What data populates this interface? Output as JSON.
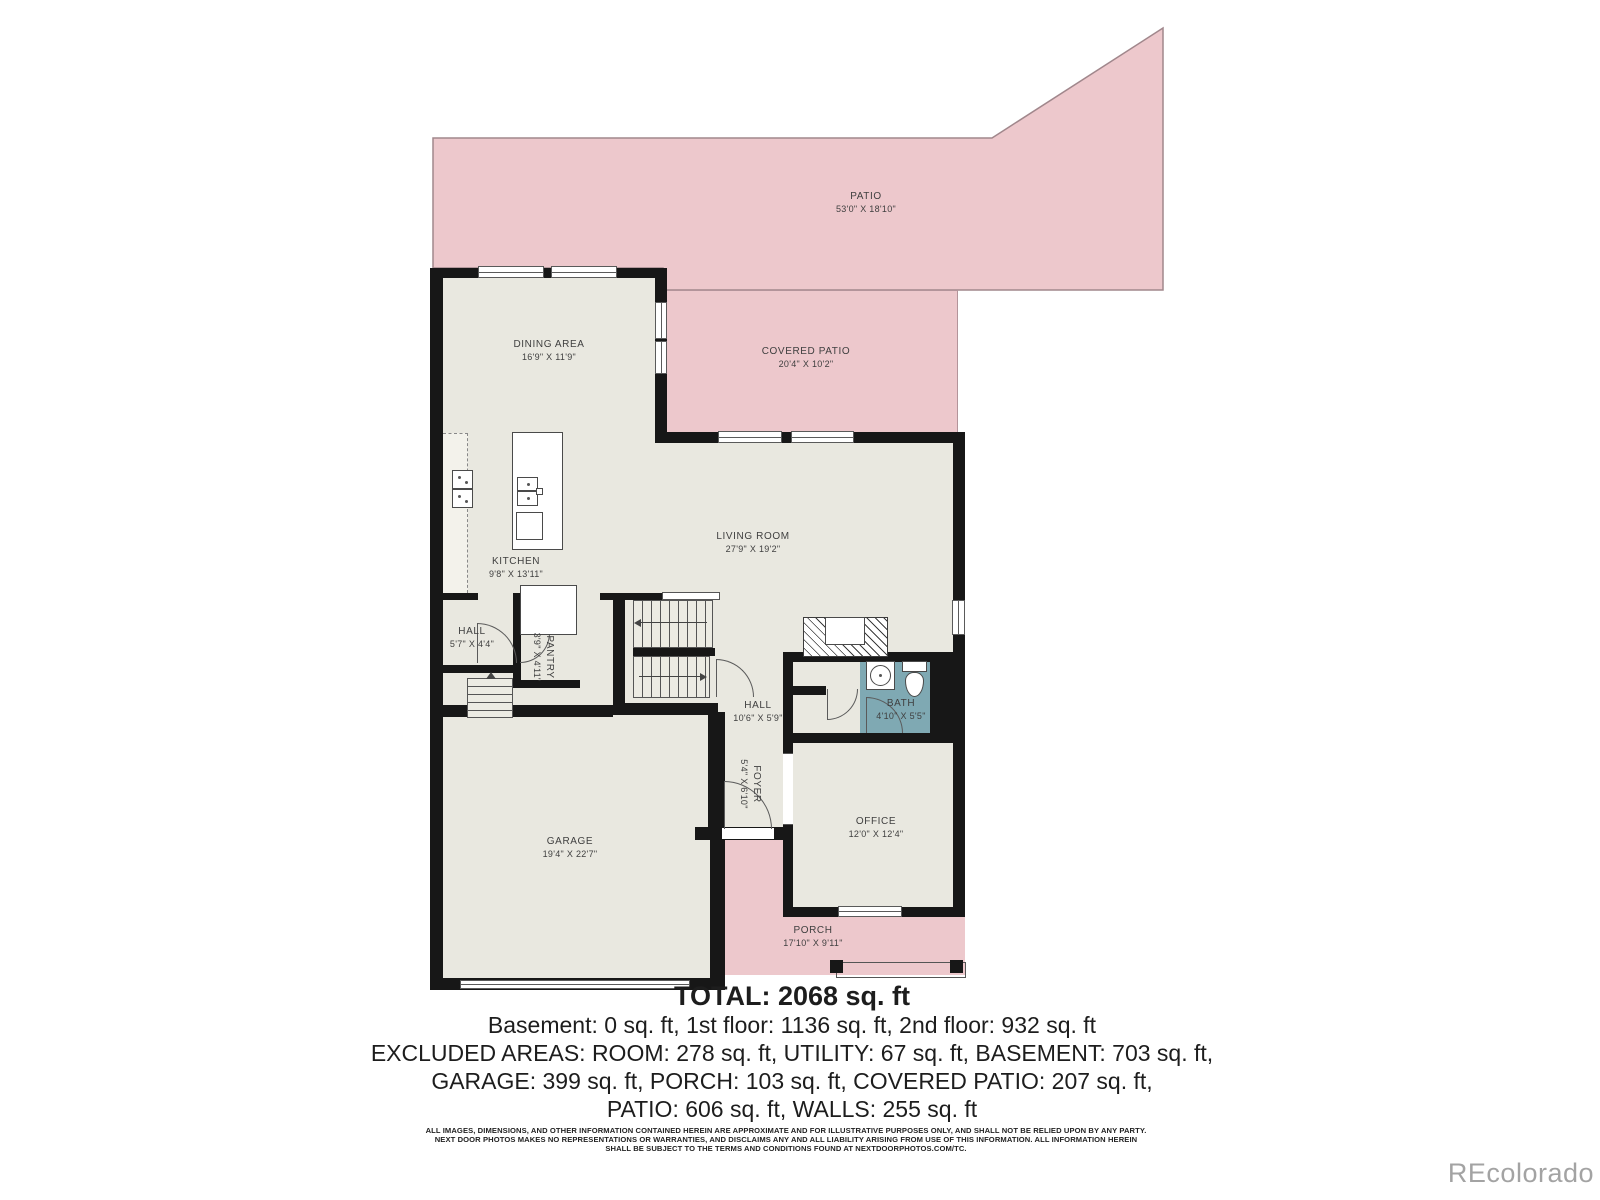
{
  "colors": {
    "room_fill": "#e9e8e0",
    "outdoor_pink": "#edc8cc",
    "outdoor_outline": "#a1878c",
    "bath_teal": "#7fa9b3",
    "wall_black": "#171717",
    "label_text": "#3f3f3f",
    "watermark_gray": "#a3a3a3"
  },
  "rooms": {
    "patio": {
      "name": "PATIO",
      "dims": "53'0\" X 18'10\""
    },
    "covered_patio": {
      "name": "COVERED PATIO",
      "dims": "20'4\" X 10'2\""
    },
    "dining": {
      "name": "DINING AREA",
      "dims": "16'9\" X 11'9\""
    },
    "kitchen": {
      "name": "KITCHEN",
      "dims": "9'8\" X 13'11\""
    },
    "living": {
      "name": "LIVING ROOM",
      "dims": "27'9\" X 19'2\""
    },
    "hall_left": {
      "name": "HALL",
      "dims": "5'7\" X 4'4\""
    },
    "pantry": {
      "name": "PANTRY",
      "dims": "3'9\" X 4'11\""
    },
    "hall_center": {
      "name": "HALL",
      "dims": "10'6\" X 5'9\""
    },
    "bath": {
      "name": "BATH",
      "dims": "4'10\" X 5'5\""
    },
    "foyer": {
      "name": "FOYER",
      "dims": "5'4\" X 6'10\""
    },
    "office": {
      "name": "OFFICE",
      "dims": "12'0\" X 12'4\""
    },
    "garage": {
      "name": "GARAGE",
      "dims": "19'4\" X 22'7\""
    },
    "porch": {
      "name": "PORCH",
      "dims": "17'10\" X 9'11\""
    }
  },
  "summary": {
    "total": "TOTAL: 2068 sq. ft",
    "line2": "Basement: 0 sq. ft, 1st floor: 1136 sq. ft, 2nd floor: 932 sq. ft",
    "line3": "EXCLUDED AREAS: ROOM: 278 sq. ft, UTILITY: 67 sq. ft, BASEMENT: 703 sq. ft,",
    "line4": "GARAGE: 399 sq. ft, PORCH: 103 sq. ft, COVERED PATIO: 207 sq. ft,",
    "line5": "PATIO: 606 sq. ft, WALLS: 255 sq. ft"
  },
  "disclaimer": {
    "line1": "ALL IMAGES, DIMENSIONS, AND OTHER INFORMATION CONTAINED HEREIN ARE APPROXIMATE AND FOR ILLUSTRATIVE PURPOSES ONLY, AND SHALL NOT BE RELIED UPON BY ANY PARTY.",
    "line2": "NEXT DOOR PHOTOS MAKES NO REPRESENTATIONS OR WARRANTIES, AND DISCLAIMS ANY AND ALL LIABILITY ARISING FROM USE OF THIS INFORMATION. ALL INFORMATION HEREIN",
    "line3": "SHALL BE SUBJECT TO THE TERMS AND CONDITIONS FOUND AT NEXTDOORPHOTOS.COM/TC."
  },
  "watermark": "REcolorado"
}
